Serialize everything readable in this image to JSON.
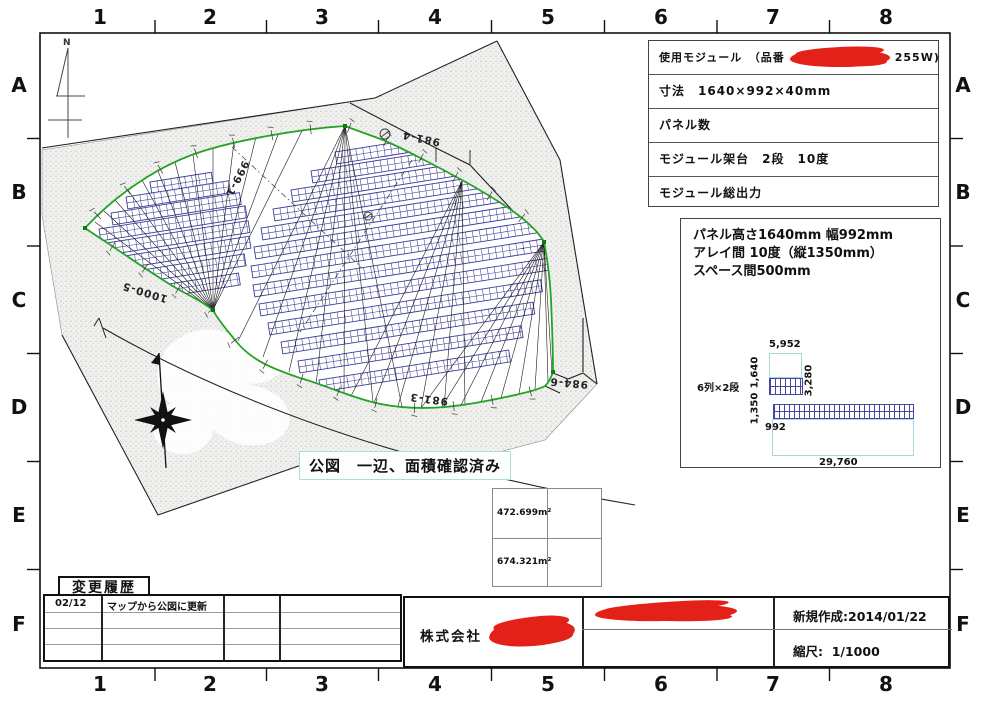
{
  "frame": {
    "columns": [
      "1",
      "2",
      "3",
      "4",
      "5",
      "6",
      "7",
      "8"
    ],
    "rows": [
      "A",
      "B",
      "C",
      "D",
      "E",
      "F"
    ]
  },
  "spec_table": {
    "row1_prefix": "使用モジュール　（品番",
    "row1_suffix": "255W)",
    "row2": "寸法　1640×992×40mm",
    "row3": "パネル数",
    "row4": "モジュール架台　2段　10度",
    "row5": "モジュール総出力"
  },
  "panel_detail": {
    "line1": "パネル高さ1640mm 幅992mm",
    "line2": "アレイ間 10度（縦1350mm）",
    "line3": "スペース間500mm",
    "array_label": "6列×2段",
    "dim_top": "5,952",
    "dim_height": "1,640",
    "dim_right": "3,280",
    "dim_pitch": "1,350",
    "dim_width": "992",
    "dim_total": "29,760"
  },
  "map": {
    "north_label": "N",
    "note": "公図　一辺、面積確認済み",
    "parcels": {
      "p1": "999-1",
      "p2": "981-4",
      "p3": "1000-5",
      "p4": "981-3",
      "p5": "984-6"
    }
  },
  "area_table": {
    "cell1": "472.699m²",
    "cell2": "674.321m²"
  },
  "history": {
    "title": "変更履歴",
    "rows": [
      {
        "date": "02/12",
        "desc": "マップから公図に更新"
      },
      {
        "date": "",
        "desc": ""
      },
      {
        "date": "",
        "desc": ""
      },
      {
        "date": "",
        "desc": ""
      }
    ]
  },
  "title_block": {
    "company": "株式会社",
    "created_label": "新規作成:",
    "created_value": "2014/01/22",
    "scale_label": "縮尺:",
    "scale_value": "1/1000"
  }
}
